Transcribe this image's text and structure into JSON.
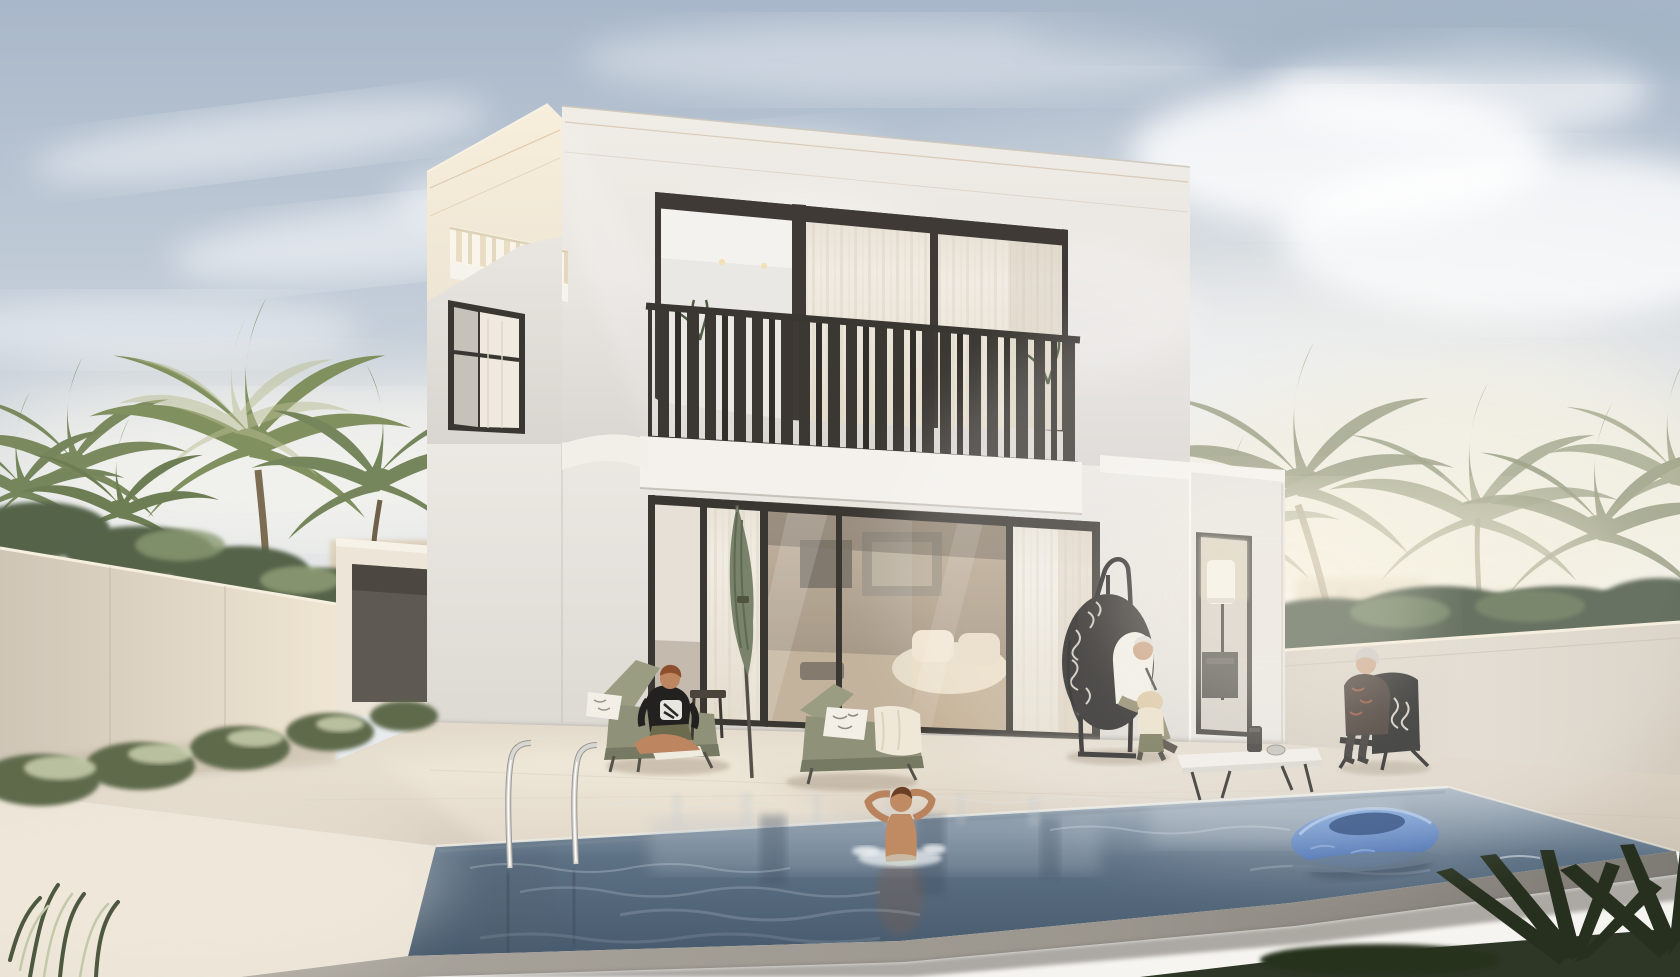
{
  "scene": {
    "name": "villa-pool-architectural-render",
    "setting": "Modern two-storey white villa with swimming pool, terrace, palm trees and perimeter walls in warm hazy daylight",
    "people": [
      {
        "name": "seated-person-on-lounger",
        "position": "left terrace",
        "clothing": "black t-shirt with white graphic, olive shorts",
        "pose": "cross-legged on sage lounger"
      },
      {
        "name": "child-in-pool",
        "position": "pool centre",
        "pose": "standing in water, hands behind head"
      },
      {
        "name": "elderly-man-in-egg-chair",
        "position": "right terrace",
        "clothing": "white shirt, khaki trousers"
      },
      {
        "name": "toddler-beside-egg-chair",
        "position": "right terrace",
        "clothing": "beige hat, cream top, olive trousers"
      },
      {
        "name": "elderly-woman-on-chair",
        "position": "far right terrace",
        "clothing": "dark patterned top, dark trousers"
      }
    ],
    "objects": [
      "villa",
      "roof-terrace-railing",
      "balcony-railing",
      "curtained-windows",
      "sliding-glass-doors",
      "living-room-interior",
      "closed-patio-umbrella",
      "sun-lounger-left",
      "sun-lounger-right",
      "towel",
      "patterned-pillows",
      "hanging-egg-chair",
      "black-lounge-chair",
      "low-coffee-table",
      "portable-speaker",
      "glass-bowl",
      "floor-lamp",
      "pool-ladder",
      "blue-pool-float",
      "swimming-pool",
      "pool-coping",
      "left-perimeter-wall",
      "right-perimeter-wall",
      "garage-annex",
      "palm-trees",
      "hedge",
      "shrub-row",
      "agave-plants",
      "foreground-grasses",
      "distant-buildings",
      "clouds"
    ]
  },
  "colors": {
    "sky_top": "#a8b7c9",
    "sky_mid": "#c9d2dc",
    "sky_horizon": "#f2f1ee",
    "haze_white": "#ffffff",
    "facade_front": "#eae7e3",
    "facade_bottom": "#d8d4d0",
    "facade_warm_top": "#f7eedb",
    "facade_warm_bottom": "#eee5d4",
    "tower_grey": "#e9e6e1",
    "frame_dark": "#3a3631",
    "glass_light": "#e9e8e4",
    "curtain": "#f1ece3",
    "railing": "#3b3733",
    "slab_white": "#f4f1ec",
    "interior_back": "#8f7f6a",
    "interior_front": "#c3b098",
    "sofa": "#e9dcc4",
    "wing_face": "#e5e2dd",
    "wall_left_near": "#cfc5b6",
    "wall_left_far": "#efe5d2",
    "wall_right": "#ddd6c9",
    "hedge": "#42503a",
    "palm": "#7e8b60",
    "deck": "#d9cfc1",
    "deck_bright": "#ece4d5",
    "pool_far": "#a3b2bf",
    "pool_mid": "#5d7185",
    "pool_deep": "#475a6d",
    "rim_grey": "#9b968e",
    "ladder_chrome": "#d9d7d1",
    "float_light": "#7aa0d6",
    "float_dark": "#3c63a6",
    "float_hole": "#27477e",
    "lounger_olive": "#8f9278",
    "umbrella_olive": "#79826a",
    "towel_cream": "#efe8d8",
    "egg_chair_black": "#211f1c",
    "chair_black": "#1d1c1a",
    "skin": "#c08a62",
    "shirt_white": "#efece3",
    "pants_khaki": "#8c8566",
    "tee_black": "#22211f",
    "hair_auburn": "#8e4f2e",
    "hair_grey": "#c7c3bd",
    "grass_foreground": "#2e3626"
  }
}
